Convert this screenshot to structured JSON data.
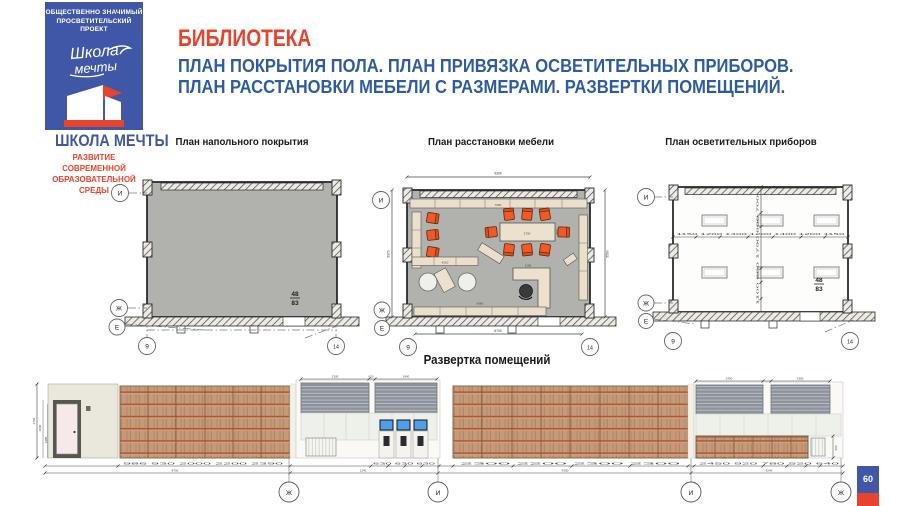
{
  "logo": {
    "project_line1": "ОБЩЕСТВЕННО ЗНАЧИМЫЙ",
    "project_line2": "ПРОСВЕТИТЕЛЬСКИЙ ПРОЕКТ",
    "script_word1": "Школа",
    "script_word2": "мечты",
    "brand_name": "ШКОЛА МЕЧТЫ",
    "tagline_line1": "РАЗВИТИЕ СОВРЕМЕННОЙ",
    "tagline_line2": "ОБРАЗОВАТЕЛЬНОЙ СРЕДЫ"
  },
  "header": {
    "title": "БИБЛИОТЕКА",
    "subtitle_line1": "ПЛАН ПОКРЫТИЯ ПОЛА. ПЛАН ПРИВЯЗКА ОСВЕТИТЕЛЬНЫХ ПРИБОРОВ.",
    "subtitle_line2": "ПЛАН РАССТАНОВКИ МЕБЕЛИ С РАЗМЕРАМИ. РАЗВЕРТКИ ПОМЕЩЕНИЙ."
  },
  "axes": {
    "top": "И",
    "middle": "Ж",
    "bottom": "Е",
    "left": "9",
    "right": "14"
  },
  "plans": {
    "floor": {
      "title": "План напольного покрытия",
      "room_number": "48",
      "room_area": "83"
    },
    "furniture": {
      "title": "План расстановки мебели",
      "dim_top": "9300",
      "dim_bottom": "8700",
      "dim_left": "5370",
      "dim_right": "5590",
      "shelf_top": "7060",
      "shelf_mid": "4210",
      "shelf_bottom": "6080",
      "table_length": "2700",
      "table_depth": "900",
      "desk": "1190"
    },
    "lighting": {
      "title": "План осветительных приборов",
      "h_chain": [
        "1150",
        "1200",
        "1400",
        "1200",
        "1400",
        "1200",
        "1150"
      ],
      "v_chain": [
        "1100",
        "600",
        "1790",
        "600",
        "700"
      ],
      "room_number": "48",
      "room_area": "83"
    }
  },
  "elevations": {
    "title": "Развертка помещений",
    "wall_height": "2760",
    "door_dims": [
      "2000",
      "1985"
    ],
    "blinds_dims_left": [
      "2300",
      "620",
      "2400"
    ],
    "blinds_dims_right": [
      "2400",
      "2300"
    ],
    "cabinet_height": "600",
    "chain_left": [
      "986",
      "930",
      "2000",
      "2200",
      "2390"
    ],
    "chain_center": [
      "630",
      "630",
      "630"
    ],
    "chain_right_wall": [
      "2300",
      "2200",
      "2300",
      "2300"
    ],
    "chain_end": [
      "2450",
      "920",
      "780",
      "520",
      "640"
    ],
    "total_left": "8700",
    "total_center": "1240",
    "total_right": "9300",
    "total_end": "5240",
    "axis_marks": [
      "Ж",
      "И",
      "И",
      "Ж"
    ]
  },
  "page": {
    "number": "60"
  },
  "colors": {
    "accent_red": "#e8432c",
    "brand_blue": "#3f57a6",
    "text_blue": "#2e5ba6",
    "chair_orange": "#f15a24",
    "floor_gray": "#b1b1ad",
    "wood": "#c49a7a",
    "shelf_line": "#b5532f",
    "blinds_gray": "#8d939b",
    "screen_blue": "#4f9fe8"
  }
}
